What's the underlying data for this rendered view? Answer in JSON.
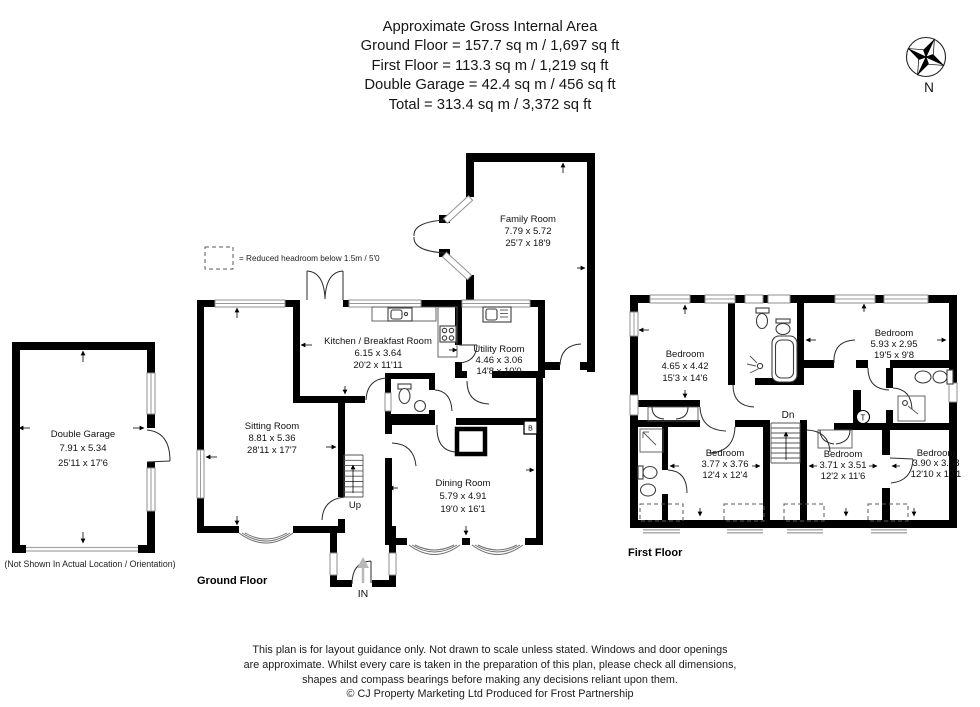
{
  "header": {
    "title": "Approximate Gross Internal Area",
    "lines": [
      "Ground Floor = 157.7 sq m / 1,697 sq ft",
      "First Floor = 113.3 sq m / 1,219 sq ft",
      "Double Garage = 42.4 sq m / 456 sq ft",
      "Total = 313.4 sq m / 3,372 sq ft"
    ]
  },
  "compass": {
    "north_label": "N"
  },
  "legend": {
    "text": "= Reduced headroom below 1.5m / 5'0"
  },
  "ground_floor": {
    "label": "Ground Floor",
    "entrance_label": "IN",
    "stairs_label": "Up",
    "boiler_label": "B",
    "rooms": {
      "family": {
        "name": "Family Room",
        "metric": "7.79 x 5.72",
        "imperial": "25'7 x 18'9"
      },
      "kitchen": {
        "name": "Kitchen / Breakfast Room",
        "metric": "6.15 x 3.64",
        "imperial": "20'2 x 11'11"
      },
      "utility": {
        "name": "Utility Room",
        "metric": "4.46 x 3.06",
        "imperial": "14'8 x 10'0"
      },
      "sitting": {
        "name": "Sitting Room",
        "metric": "8.81 x 5.36",
        "imperial": "28'11 x 17'7"
      },
      "dining": {
        "name": "Dining Room",
        "metric": "5.79 x 4.91",
        "imperial": "19'0 x 16'1"
      }
    }
  },
  "garage": {
    "name": "Double Garage",
    "metric": "7.91 x 5.34",
    "imperial": "25'11 x 17'6",
    "note": "(Not Shown In Actual Location / Orientation)"
  },
  "first_floor": {
    "label": "First Floor",
    "stairs_label": "Dn",
    "tank_label": "T",
    "rooms": {
      "bed1": {
        "name": "Bedroom",
        "metric": "4.65 x 4.42",
        "imperial": "15'3 x 14'6"
      },
      "bed2": {
        "name": "Bedroom",
        "metric": "5.93 x 2.95",
        "imperial": "19'5 x 9'8"
      },
      "bed3": {
        "name": "Bedroom",
        "metric": "3.77 x 3.76",
        "imperial": "12'4 x 12'4"
      },
      "bed4": {
        "name": "Bedroom",
        "metric": "3.71 x 3.51",
        "imperial": "12'2 x 11'6"
      },
      "bed5": {
        "name": "Bedroom",
        "metric": "3.90 x 3.08",
        "imperial": "12'10 x 10'1"
      }
    }
  },
  "footer": {
    "lines": [
      "This plan is for layout guidance only. Not drawn to scale unless stated. Windows and door openings",
      "are approximate. Whilst every care is taken in the preparation of this plan, please check all dimensions,",
      "shapes and compass bearings before making any decisions reliant upon them.",
      "© CJ Property Marketing Ltd Produced for Frost Partnership"
    ]
  },
  "colors": {
    "wall": "#000000",
    "window_gray": "#9a9a9a",
    "entrance_arrow": "#b8b8b8"
  }
}
